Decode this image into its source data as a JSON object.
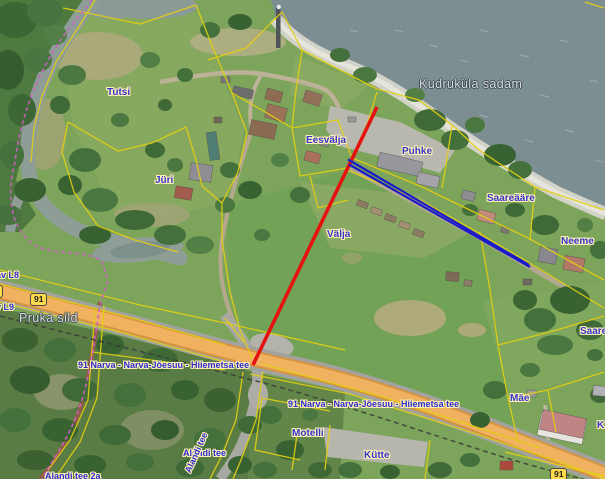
{
  "map": {
    "labels": [
      {
        "id": "tutsi",
        "text": "Tutsi",
        "kind": "parcel",
        "x": 107,
        "y": 88
      },
      {
        "id": "jyri",
        "text": "Jüri",
        "kind": "parcel",
        "x": 155,
        "y": 176
      },
      {
        "id": "eesvalja",
        "text": "Eesvälja",
        "kind": "parcel",
        "x": 306,
        "y": 136
      },
      {
        "id": "puhke",
        "text": "Puhke",
        "kind": "parcel",
        "x": 402,
        "y": 147
      },
      {
        "id": "valja",
        "text": "Välja",
        "kind": "parcel",
        "x": 327,
        "y": 230
      },
      {
        "id": "saareaare",
        "text": "Saareääre",
        "kind": "parcel",
        "x": 487,
        "y": 194
      },
      {
        "id": "neeme",
        "text": "Neeme",
        "kind": "parcel",
        "x": 561,
        "y": 237
      },
      {
        "id": "saare",
        "text": "Saare",
        "kind": "parcel",
        "x": 580,
        "y": 327
      },
      {
        "id": "mae",
        "text": "Mäe",
        "kind": "parcel",
        "x": 510,
        "y": 394
      },
      {
        "id": "motelli",
        "text": "Motelli",
        "kind": "parcel",
        "x": 292,
        "y": 429
      },
      {
        "id": "kytte",
        "text": "Kütte",
        "kind": "parcel",
        "x": 364,
        "y": 451
      },
      {
        "id": "k-clipped",
        "text": "K",
        "kind": "parcel",
        "x": 597,
        "y": 421
      },
      {
        "id": "kudrukyla-sadam",
        "text": "Kudruküla sadam",
        "kind": "water",
        "x": 419,
        "y": 78
      },
      {
        "id": "pruka-sild",
        "text": "Pruka sild",
        "kind": "water",
        "x": 19,
        "y": 312
      },
      {
        "id": "road-91-label-west",
        "text": "91 Narva - Narva-Jõesuu - Hiiemetsa tee",
        "kind": "road",
        "x": 78,
        "y": 361
      },
      {
        "id": "road-91-label-east",
        "text": "91 Narva - Narva-Jõesuu - Hiiemetsa tee",
        "kind": "road",
        "x": 288,
        "y": 400
      },
      {
        "id": "alandi-tee",
        "text": "Alandi tee",
        "kind": "road",
        "x": 183,
        "y": 449
      },
      {
        "id": "alandi-tee-along-road",
        "text": "Alandi tee",
        "kind": "road",
        "x": 188,
        "y": 468,
        "rot": -66
      },
      {
        "id": "av-l8",
        "text": "av L8",
        "kind": "road",
        "x": -4,
        "y": 271
      },
      {
        "id": "v-l9",
        "text": "v L9",
        "kind": "road",
        "x": -4,
        "y": 303
      },
      {
        "id": "alandi-tee-2a",
        "text": "Alandi tee 2a",
        "kind": "road",
        "x": 45,
        "y": 472
      }
    ],
    "shields": [
      {
        "text": "91",
        "x": 30,
        "y": 293
      },
      {
        "text": "91",
        "x": -14,
        "y": 285
      },
      {
        "text": "91",
        "x": 550,
        "y": 468
      }
    ],
    "lines": {
      "red_measure": {
        "x1": 377,
        "y1": 107,
        "x2": 253,
        "y2": 365,
        "color": "#e51310"
      },
      "blue_measure": {
        "x1": 348,
        "y1": 162,
        "x2": 529,
        "y2": 266,
        "color": "#1a1ac8"
      }
    },
    "palette": {
      "cadastral_line": "#e3cf12",
      "road_fill": "#f0b161",
      "water": "#7d8e92",
      "label_blue": "#3434cf",
      "label_halo": "#fdf1b4",
      "trail_pink": "#cf5fc4"
    }
  }
}
